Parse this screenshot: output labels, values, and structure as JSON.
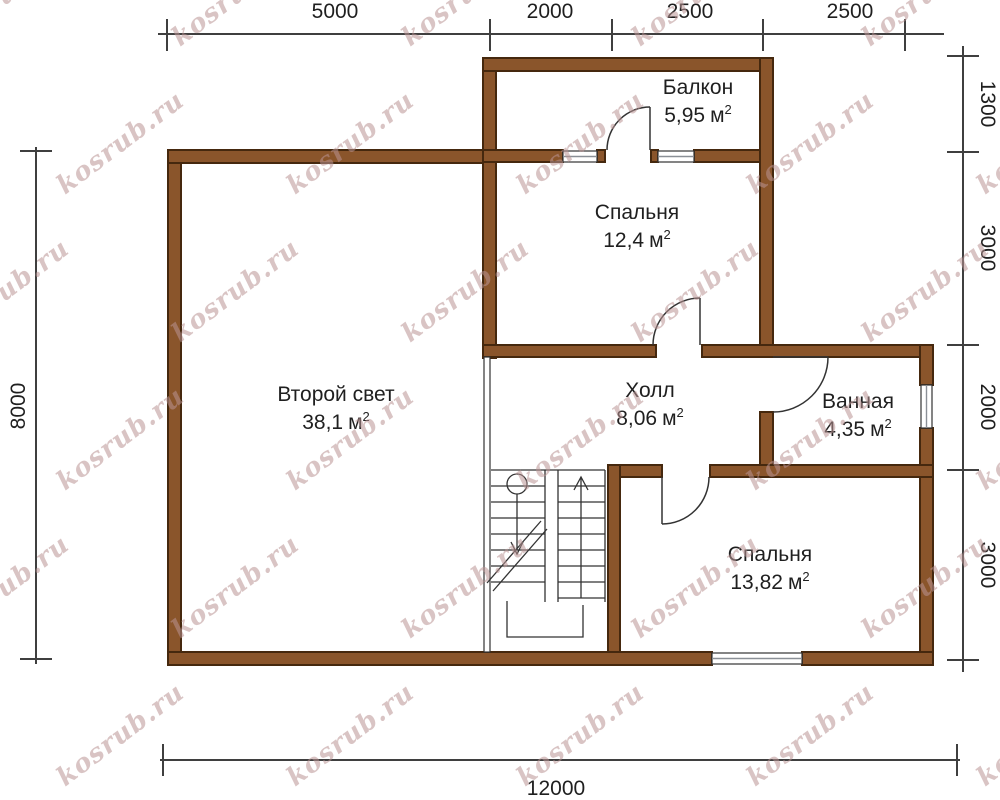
{
  "watermark": {
    "text": "kosrub.ru",
    "color": "#ba9494"
  },
  "colors": {
    "wall_fill": "#8a552b",
    "wall_outline": "#45280e",
    "line": "#3f3f3f",
    "text": "#1f1f1f",
    "background": "#ffffff"
  },
  "unit": {
    "base": "м",
    "sup": "2"
  },
  "dimensions": {
    "top": [
      "5000",
      "2000",
      "2500",
      "2500"
    ],
    "right": [
      "1300",
      "3000",
      "2000",
      "3000"
    ],
    "left": [
      "8000"
    ],
    "bottom": [
      "12000"
    ]
  },
  "rooms": [
    {
      "name": "Балкон",
      "area": "5,95"
    },
    {
      "name": "Спальня",
      "area": "12,4"
    },
    {
      "name": "Второй свет",
      "area": "38,1"
    },
    {
      "name": "Холл",
      "area": "8,06"
    },
    {
      "name": "Ванная",
      "area": "4,35"
    },
    {
      "name": "Спальня",
      "area": "13,82"
    }
  ]
}
